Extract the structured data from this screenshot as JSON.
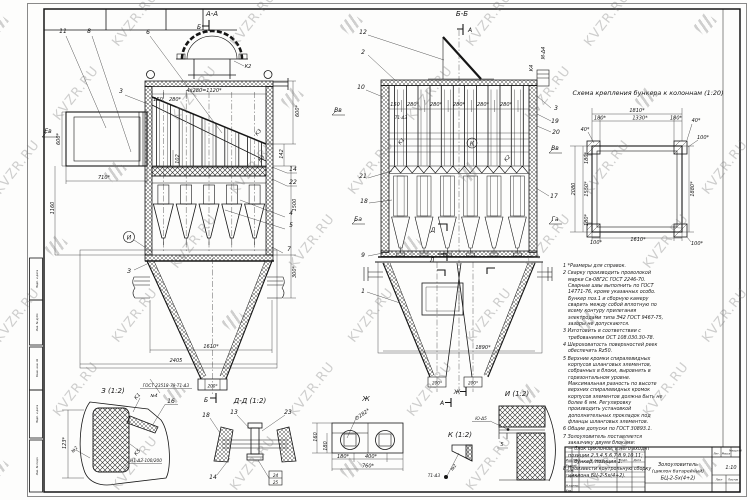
{
  "watermark": {
    "text": "KVZR.RU"
  },
  "front": {
    "section": "А-А",
    "cut_b": "Б",
    "c11": "11",
    "c8": "8",
    "c6": "6",
    "c3": "3",
    "c14": "14",
    "c22": "22",
    "c4": "4",
    "c5": "5",
    "c7": "7",
    "det_i": "И",
    "det_z": "З",
    "k2": "К2",
    "k3": "К3",
    "ev": "Ев",
    "d1120": "4x280=1120*",
    "d150": "150",
    "d280": "280*",
    "d600": "600*",
    "d600r": "600*",
    "d710": "710*",
    "d1160": "1160",
    "d102": "102",
    "d142": "142",
    "d1500": "1500",
    "d300": "300*",
    "d2405": "2405",
    "d1610": "1610*",
    "d200": "200*",
    "gost_weld": "ГОСТ 23518-79-Т1-Δ3",
    "n4": "№4"
  },
  "sec": {
    "section": "Б-Б",
    "cut_a": "А",
    "c12": "12",
    "c2": "2",
    "c10": "10",
    "c21": "21",
    "c18": "18",
    "c9": "9",
    "c1": "1",
    "c3": "3",
    "c19": "19",
    "c20": "20",
    "c17": "17",
    "k1": "К1",
    "k2": "К2",
    "k4": "К4",
    "m4": "М-Δ4",
    "t1": "Т1-Δ3",
    "kc": "К",
    "vv_l": "Вв",
    "vv_r": "Вв",
    "ba": "Ба",
    "ga": "Га",
    "d150": "150",
    "d280": "280*",
    "d1890": "1890*",
    "d200": "200*",
    "md": "Д",
    "ml": "Л",
    "mzh": "Ж"
  },
  "scheme": {
    "title": "Схема крепления бункера к колоннам (1:20)",
    "d1810": "1810*",
    "d180": "180*",
    "d1330": "1330*",
    "d40": "40*",
    "d100": "100*",
    "d2080": "2080",
    "d1550": "1550*",
    "d1880": "1880*",
    "d1610": "1610*"
  },
  "notes": {
    "n1": "1 *Размеры для справок.",
    "n2": "2 Сварку производить проволокой марки Св-08Г2С ГОСТ 2246-70. Сварные швы выполнить по ГОСТ 14771-76, кроме указанных особо. Бункер поз.1 и сборную камеру сварить между собой вплотную по всему контуру прилегания электродами типа Э42 ГОСТ 9467-75, зазоры не допускаются.",
    "n3": "3 Изготовить в соответствии с требованиями ОСТ 108.030.30-78.",
    "n4": "4 Шероховатость поверхностей реек обеспечить Rz50.",
    "n5": "5 Верхние кромки спиралевидных корпусов шланговых элементов, собранных в блоки, выровнять в горизонтальном уровне. Максимальная разность по высоте верхних спиралевидных кромок корпусов элементов должна быть не более 6 мм. Регулировку производить установкой дополнительных прокладок под фланцы шланговых элементов.",
    "n6": "6 Общие допуски по ГОСТ 30893.1.",
    "n7": "7 Золоуловитель поставляется заказчику двумя блоками:\n— блок циклонов, в него входят позиции 2,3,4,5,6,7,8,9,10,11;\n— бункер, позиция 1.",
    "n8": "8 Произвести контрольную сборку циклона БЦ-2-5х(4+2)."
  },
  "details": {
    "z": {
      "label": "З (1:2)",
      "k1": "К1",
      "c16": "16",
      "k5": "К5",
      "weld": "Н1-Δ3-100/200",
      "d123": "123*",
      "n2": "№2"
    },
    "dd": {
      "label": "Д-Д (1:2)",
      "c18": "18",
      "c13": "13",
      "c23": "23",
      "c14": "14",
      "c24": "24",
      "c25": "25"
    },
    "zh": {
      "label": "Ж",
      "d160": "160",
      "d180": "180",
      "d180s": "180*",
      "d400": "400*",
      "d760": "760*",
      "dia": "∅282*"
    },
    "k": {
      "label": "К (1:2)",
      "weld": "Т1-Δ3",
      "n2": "№2"
    },
    "i": {
      "label": "И (1:2)",
      "weld": "Ю-Δ5",
      "d5": "5"
    }
  },
  "titleblock": {
    "title1": "Золоуловитель",
    "title2": "(циклон батарейный)",
    "title3": "БЦ-2-5х(4+2)",
    "scale": "1:10",
    "h_izm": "Изм.",
    "h_list": "Лист",
    "h_doc": "№ докум.",
    "h_podp": "Подп.",
    "h_data": "Дата",
    "r_razrab": "Разраб.",
    "r_prov": "Пров.",
    "r_tkontr": "Т.контр.",
    "r_nkontr": "Н.контр.",
    "r_utv": "Утв.",
    "h_lit": "Лит.",
    "h_mass": "Масса",
    "h_scale": "Масштаб",
    "f_list": "Лист",
    "f_listov": "Листов"
  },
  "margins": {
    "s1": "Инв. № подл.",
    "s2": "Подп. и дата",
    "s3": "Взам. инв. №",
    "s4": "Инв. № дубл.",
    "s5": "Подп. и дата"
  }
}
